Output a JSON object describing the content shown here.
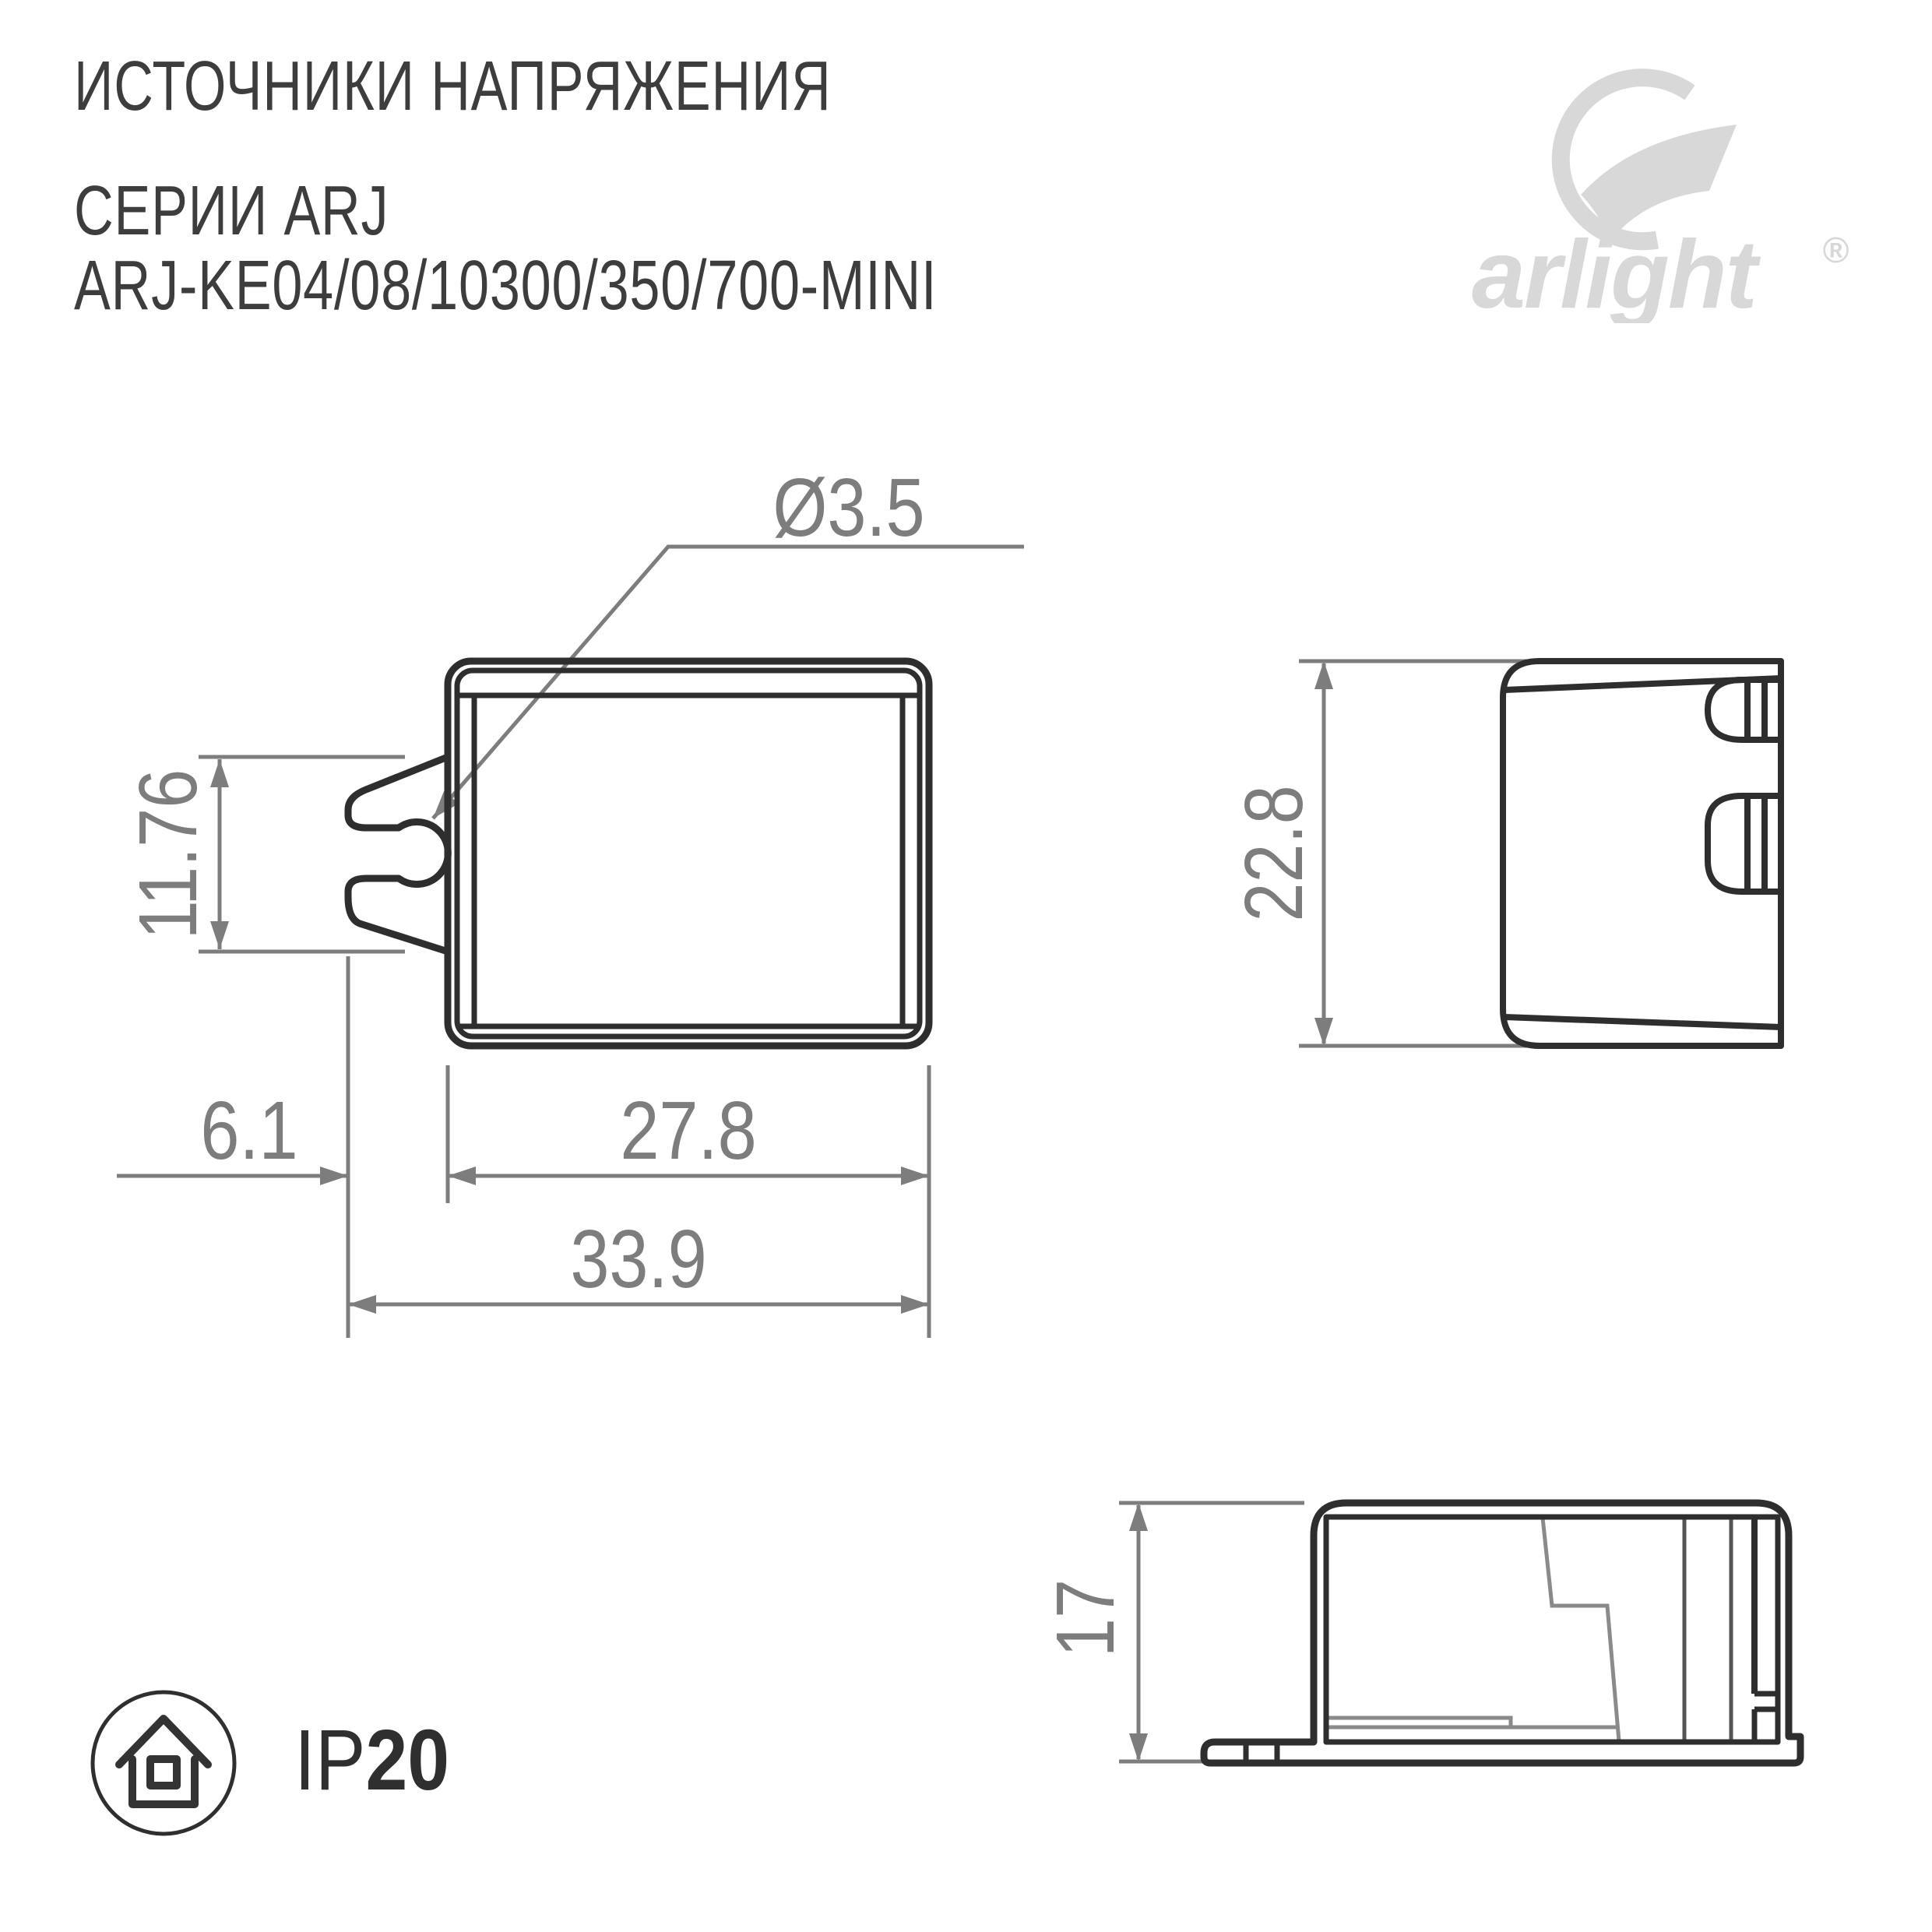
{
  "header": {
    "title_line1": "ИСТОЧНИКИ НАПРЯЖЕНИЯ",
    "title_line2": "СЕРИИ ARJ",
    "title_line3": "ARJ-KE04/08/10300/350/700-MINI"
  },
  "logo": {
    "brand": "arlight",
    "registered_mark": "®"
  },
  "drawing": {
    "front_view": {
      "hole_diameter_label": "Ø3.5",
      "tab_height_label": "11.76",
      "tab_offset_label": "6.1",
      "body_width_label": "27.8",
      "total_width_label": "33.9"
    },
    "side_view": {
      "height_label": "22.8"
    },
    "profile_view": {
      "height_label": "17"
    }
  },
  "footer": {
    "ip_prefix": "IP",
    "ip_value": "20"
  },
  "colors": {
    "line_dark": "#2e2e2e",
    "dimension_gray": "#7d7d7d",
    "title_text": "#3d3d3d",
    "logo_gray": "#d8d8d8",
    "background": "#ffffff"
  }
}
